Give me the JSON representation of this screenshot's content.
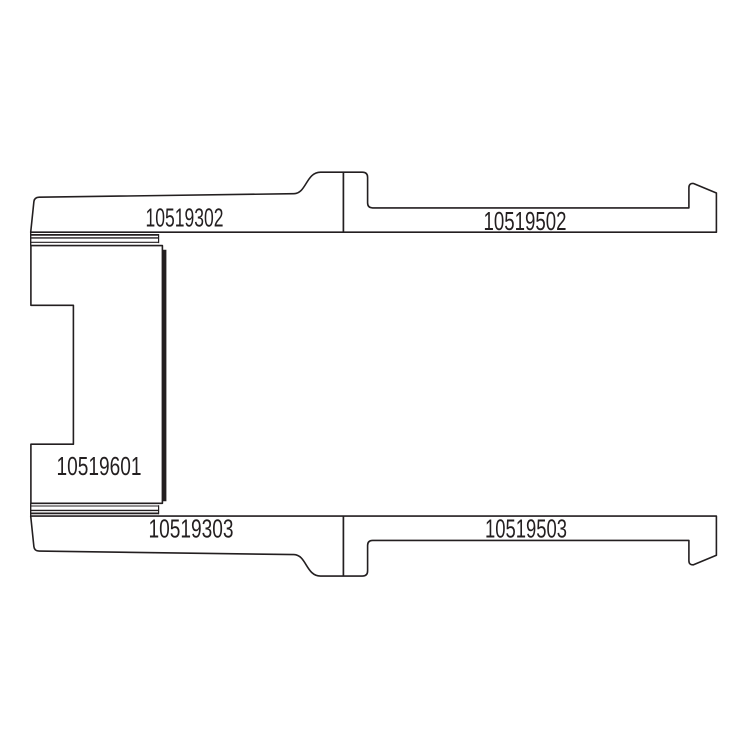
{
  "diagram": {
    "description": "Technical cross-section parts diagram with five labeled components",
    "colors": {
      "line": "#231f20",
      "background": "#ffffff"
    },
    "parts": {
      "top_left": {
        "label": "10519302"
      },
      "top_right": {
        "label": "10519502"
      },
      "middle_left": {
        "label": "10519601"
      },
      "bottom_left": {
        "label": "10519303"
      },
      "bottom_right": {
        "label": "10519503"
      }
    }
  }
}
